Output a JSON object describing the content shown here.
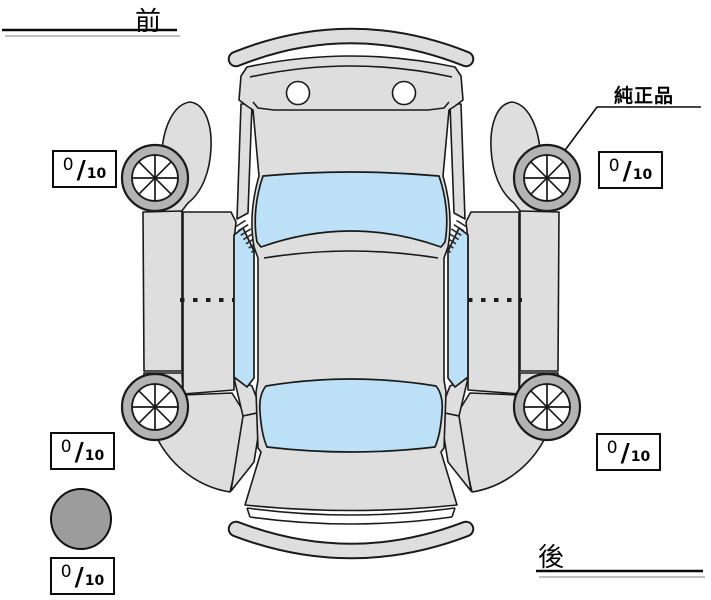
{
  "labels": {
    "front": "前",
    "rear": "後",
    "genuine_part": "純正品"
  },
  "score_separator": "/",
  "tire_scores": {
    "front_left": {
      "value": "0",
      "max": "10"
    },
    "front_right": {
      "value": "0",
      "max": "10"
    },
    "rear_left": {
      "value": "0",
      "max": "10"
    },
    "rear_right": {
      "value": "0",
      "max": "10"
    },
    "spare": {
      "value": "0",
      "max": "10"
    }
  },
  "colors": {
    "body": "#dedede",
    "glass": "#bce0f5",
    "tire": "#b3b3b3",
    "spare-tire": "#9c9c9c",
    "outline": "#1a1a1a",
    "background": "#ffffff"
  }
}
